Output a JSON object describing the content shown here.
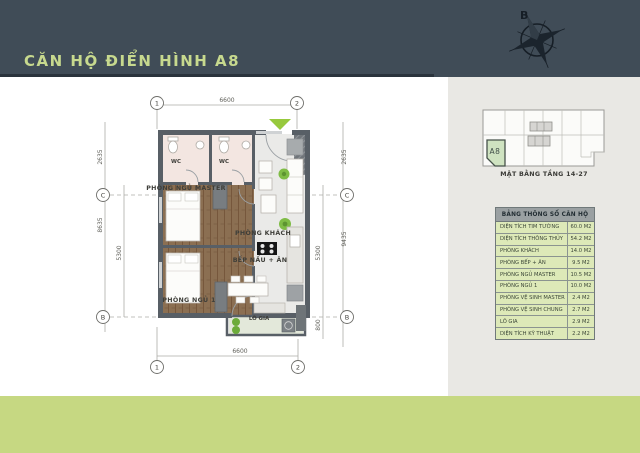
{
  "header": {
    "title": "CĂN HỘ ĐIỂN HÌNH A8",
    "compass_label": "B"
  },
  "key_plan": {
    "unit_label": "A8",
    "caption": "MẶT BẰNG TẦNG 14-27"
  },
  "spec_table": {
    "title": "BẢNG THÔNG SỐ CĂN HỘ",
    "rows": [
      {
        "label": "DIỆN TÍCH TIM TƯỜNG",
        "value": "60.0  M2"
      },
      {
        "label": "DIỆN TÍCH THÔNG THỦY",
        "value": "54.2  M2"
      },
      {
        "label": "PHÒNG KHÁCH",
        "value": "14.0  M2"
      },
      {
        "label": "PHÒNG BẾP + ĂN",
        "value": "9.5  M2"
      },
      {
        "label": "PHÒNG NGỦ MASTER",
        "value": "10.5  M2"
      },
      {
        "label": "PHÒNG NGỦ 1",
        "value": "10.0  M2"
      },
      {
        "label": "PHÒNG VỆ SINH MASTER",
        "value": "2.4  M2"
      },
      {
        "label": "PHÒNG VỆ SINH CHUNG",
        "value": "2.7  M2"
      },
      {
        "label": "LÔ GIA",
        "value": "2.9  M2"
      },
      {
        "label": "DIỆN TÍCH KỸ THUẬT",
        "value": "2.2  M2"
      }
    ]
  },
  "floor_plan": {
    "rooms": {
      "master": "PHÒNG NGỦ MASTER",
      "living": "PHÒNG KHÁCH",
      "kitchen": "BẾP NẤU + ĂN",
      "bedroom1": "PHÒNG NGỦ 1",
      "balcony": "LÔ GIA",
      "wc": "WC"
    },
    "dims": {
      "top": "6600",
      "bottom": "6600",
      "left_top": "2635",
      "left_outer": "8635",
      "left_inner": "5300",
      "right_top": "2635",
      "right_outer": "9435",
      "right_inner": "5300",
      "right_balcony": "800"
    },
    "grid": {
      "col1": "1",
      "col2": "2",
      "row_c": "C",
      "row_b": "B"
    }
  },
  "colors": {
    "header_slate": "#404c57",
    "title_green": "#c7d98e",
    "lime_band": "#c6d882",
    "table_row_green": "#dde9b8",
    "unit_highlight": "#cfe3c1",
    "accent_green": "#97c93d"
  }
}
